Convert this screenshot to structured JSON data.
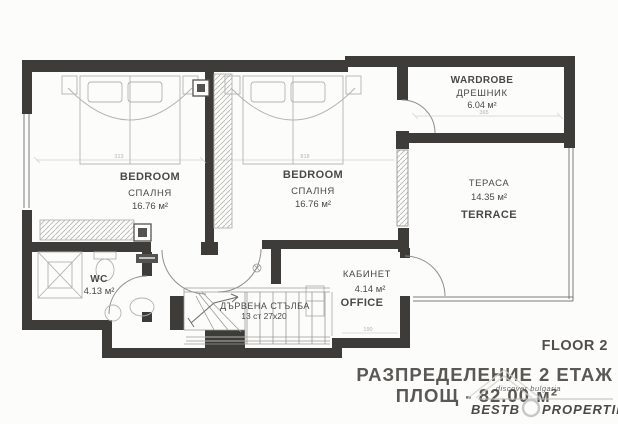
{
  "document": {
    "floor_label": "FLOOR 2",
    "title_line1": "РАЗПРЕДЕЛЕНИЕ  2 ЕТАЖ",
    "title_line2": "ПЛОЩ  -  82.00 м²"
  },
  "rooms": {
    "bedroom_left": {
      "name": "BEDROOM",
      "name_bg": "СПАЛНЯ",
      "area": "16.76 м²"
    },
    "bedroom_middle": {
      "name": "BEDROOM",
      "name_bg": "СПАЛНЯ",
      "area": "16.76 м²"
    },
    "wardrobe": {
      "name": "WARDROBE",
      "name_bg": "ДРЕШНИК",
      "area": "6.04 м²"
    },
    "terrace": {
      "name": "TERRACE",
      "name_bg": "ТЕРАСА",
      "area": "14.35 м²"
    },
    "wc": {
      "name": "WC",
      "area": "4.13 м²"
    },
    "office": {
      "name": "OFFICE",
      "name_bg": "КАБИНЕТ",
      "area": "4.14 м²"
    },
    "staircase": {
      "name_bg": "ДЪРВЕНА СТЪЛБА",
      "steps": "13 ст 27х20"
    }
  },
  "dimensions": {
    "bedroom_left_width": "313",
    "bedroom_middle_width": "818",
    "wardrobe_width": "365",
    "office_width": "190"
  },
  "watermark": {
    "brand_left": "BESTB",
    "brand_right": "PROPERTIES",
    "tagline": "discover bulgaria"
  },
  "colors": {
    "wall": "#3e3c38",
    "text": "#4b4946",
    "watermark_gray": "#c9c9c4",
    "tagline_orange": "#dd9b4a"
  }
}
